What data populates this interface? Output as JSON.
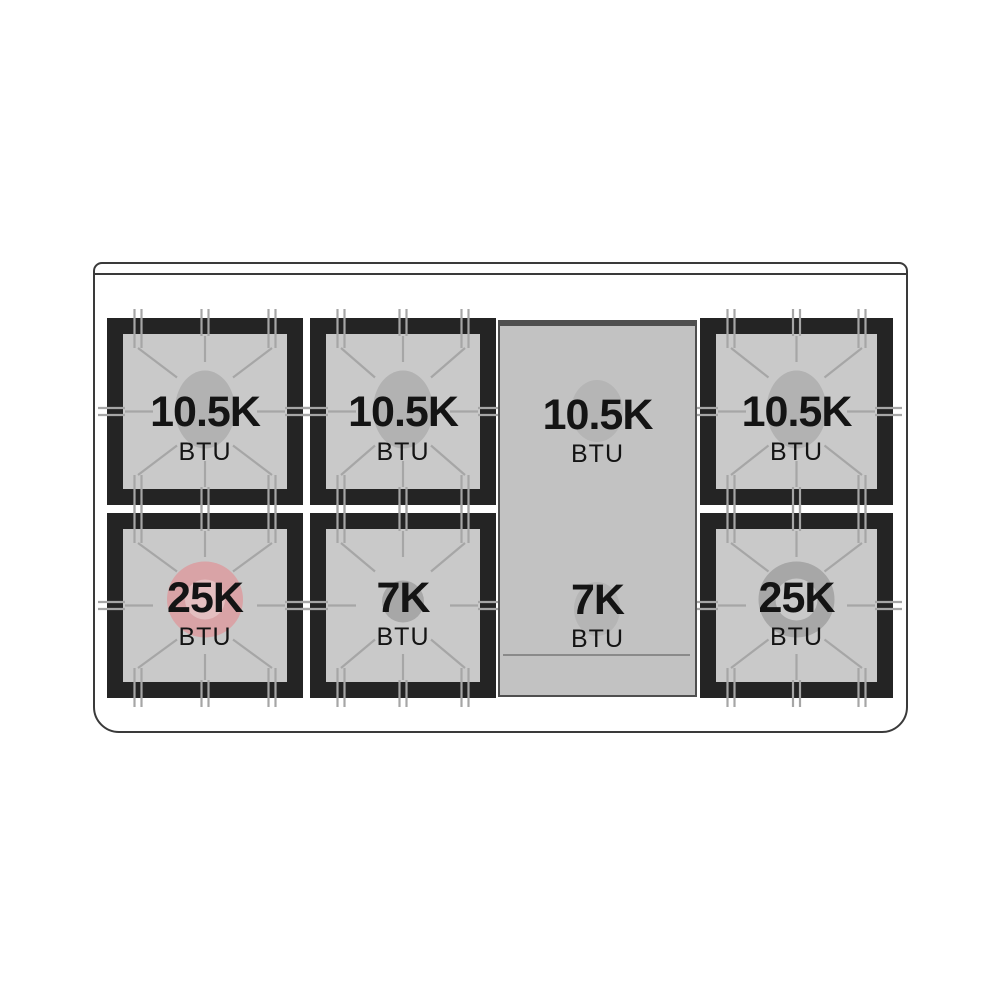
{
  "diagram": {
    "type": "cooktop-burner-layout",
    "unit_label": "BTU",
    "burners": [
      {
        "id": "top-left",
        "btu": "10.5K",
        "unit": "BTU",
        "style": "oval",
        "surface": "grate"
      },
      {
        "id": "top-center",
        "btu": "10.5K",
        "unit": "BTU",
        "style": "oval",
        "surface": "grate"
      },
      {
        "id": "griddle-top",
        "btu": "10.5K",
        "unit": "BTU",
        "style": "griddle_oval",
        "surface": "griddle"
      },
      {
        "id": "top-right",
        "btu": "10.5K",
        "unit": "BTU",
        "style": "oval",
        "surface": "grate"
      },
      {
        "id": "bottom-left",
        "btu": "25K",
        "unit": "BTU",
        "style": "pink_ring",
        "surface": "grate"
      },
      {
        "id": "bottom-center",
        "btu": "7K",
        "unit": "BTU",
        "style": "small_disc",
        "surface": "grate"
      },
      {
        "id": "griddle-bottom",
        "btu": "7K",
        "unit": "BTU",
        "style": "griddle_oval",
        "surface": "griddle"
      },
      {
        "id": "bottom-right",
        "btu": "25K",
        "unit": "BTU",
        "style": "gray_ring",
        "surface": "grate"
      }
    ],
    "colors": {
      "outline": "#3a3a3a",
      "frame_black": "#242424",
      "grate_gray": "#c9c9c9",
      "finger_line": "#a6a6a6",
      "griddle_gray": "#c2c2c2",
      "griddle_edge": "#4f4f4f",
      "burner_oval_gray": "#b2b2b2",
      "burner_pink": "#d9a3a6",
      "burner_pink_inner": "#e4bfc0",
      "burner_dark_gray": "#a7a7a7",
      "burner_dark_inner": "#c9c9c9",
      "griddle_burner_gray": "#b5b5b5",
      "text": "#141414"
    }
  }
}
